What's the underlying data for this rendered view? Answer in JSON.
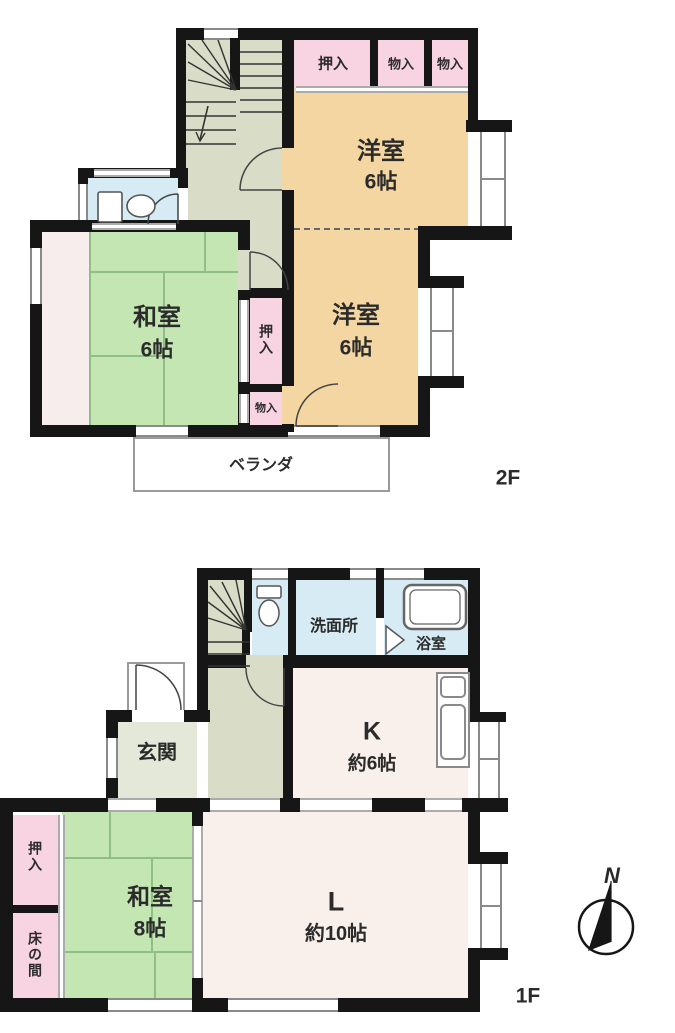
{
  "compass": {
    "north": "N"
  },
  "colors": {
    "wall": "#161616",
    "tatami_room": "#c3e6b2",
    "wood_room": "#f3d6a2",
    "closet_pink": "#f8d3e2",
    "water_blue": "#d6ebf4",
    "hall_sage": "#d9dcc6",
    "entrance_sage": "#e4e8d8",
    "living_offwhite": "#f9efeb",
    "alcove_strip": "#f7eded"
  },
  "f2": {
    "floor_label": "2F",
    "closet_top": "押入",
    "storage_1": "物入",
    "storage_2": "物入",
    "western_upper": {
      "name": "洋室",
      "size": "6帖"
    },
    "western_lower": {
      "name": "洋室",
      "size": "6帖"
    },
    "japanese": {
      "name": "和室",
      "size": "6帖"
    },
    "closet_mid": "押入",
    "storage_mid": "物入",
    "veranda": "ベランダ"
  },
  "f1": {
    "floor_label": "1F",
    "washroom": "洗面所",
    "bathroom": "浴室",
    "entrance": "玄関",
    "kitchen": {
      "name": "K",
      "size": "約6帖"
    },
    "living": {
      "name": "L",
      "size": "約10帖"
    },
    "japanese": {
      "name": "和室",
      "size": "8帖"
    },
    "closet": "押入",
    "alcove": "床の間"
  }
}
